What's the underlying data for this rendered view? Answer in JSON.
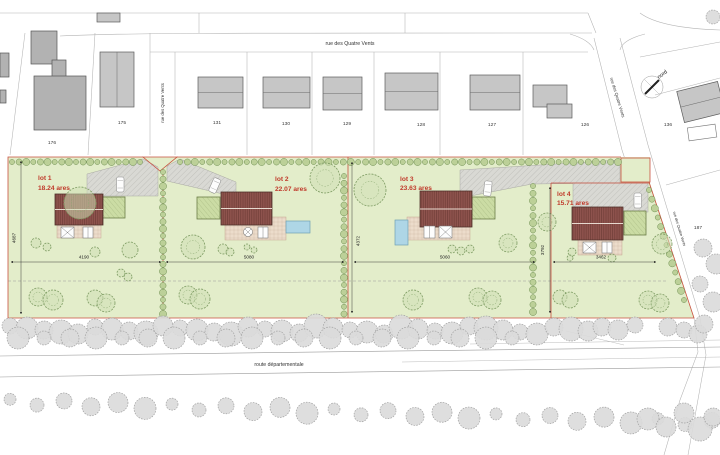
{
  "streets": {
    "rue": "rue des Quatre Vents",
    "route": "route départementale"
  },
  "north_label": "nord",
  "parcels": [
    "176",
    "175",
    "131",
    "130",
    "129",
    "128",
    "127",
    "126",
    "136",
    "187"
  ],
  "lots": [
    {
      "name": "lot 1",
      "area": "18.24 ares",
      "width": "4190",
      "height": "4687"
    },
    {
      "name": "lot 2",
      "area": "22.07 ares",
      "width": "5080"
    },
    {
      "name": "lot 3",
      "area": "23.63 ares",
      "width": "5060",
      "height": "4372"
    },
    {
      "name": "lot 4",
      "area": "15.71 ares",
      "width": "3462",
      "height": "3792"
    }
  ],
  "colors": {
    "lawn": "#e3edca",
    "roof": "#8f544e",
    "terrace": "#ecdccb",
    "drive": "#d9d9d4",
    "garden": "#cbdca4",
    "pool": "#aed6e6",
    "boundary": "#c9503f",
    "label_red": "#c03a2b",
    "building": "#c6c6c6",
    "building_dark": "#b2b2b2",
    "hedge": "#bcd098",
    "tree": "#cfdfb4",
    "bush": "#dadada",
    "line": "#9b9b9b"
  }
}
